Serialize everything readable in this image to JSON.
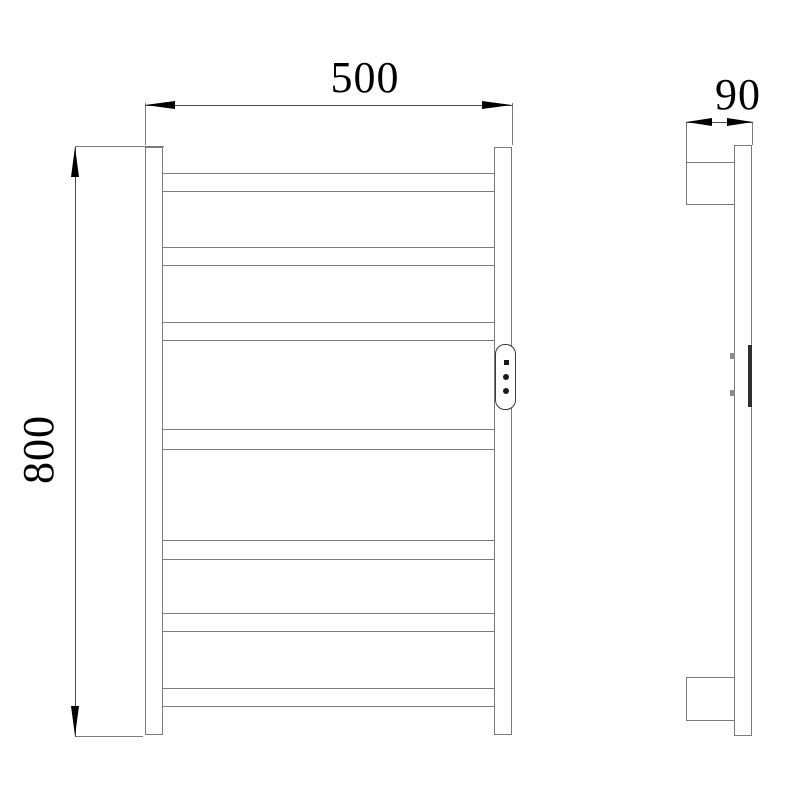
{
  "drawing": {
    "dimensions": {
      "width": "500",
      "height": "800",
      "depth": "90"
    },
    "front_view": {
      "rung_count": 7,
      "rail_count": 2,
      "control_panel": {
        "button_count": 3,
        "buttons": [
          "square-indicator",
          "round-button",
          "round-button"
        ]
      }
    },
    "side_view": {
      "bracket_count": 2,
      "has_control_panel_edge": true
    },
    "colors": {
      "background": "#ffffff",
      "outline_gray": "#7b7b7b",
      "dimension_line": "#4a4a4a",
      "arrow_and_text": "#000000",
      "panel_dark": "#2e2e2e"
    }
  }
}
